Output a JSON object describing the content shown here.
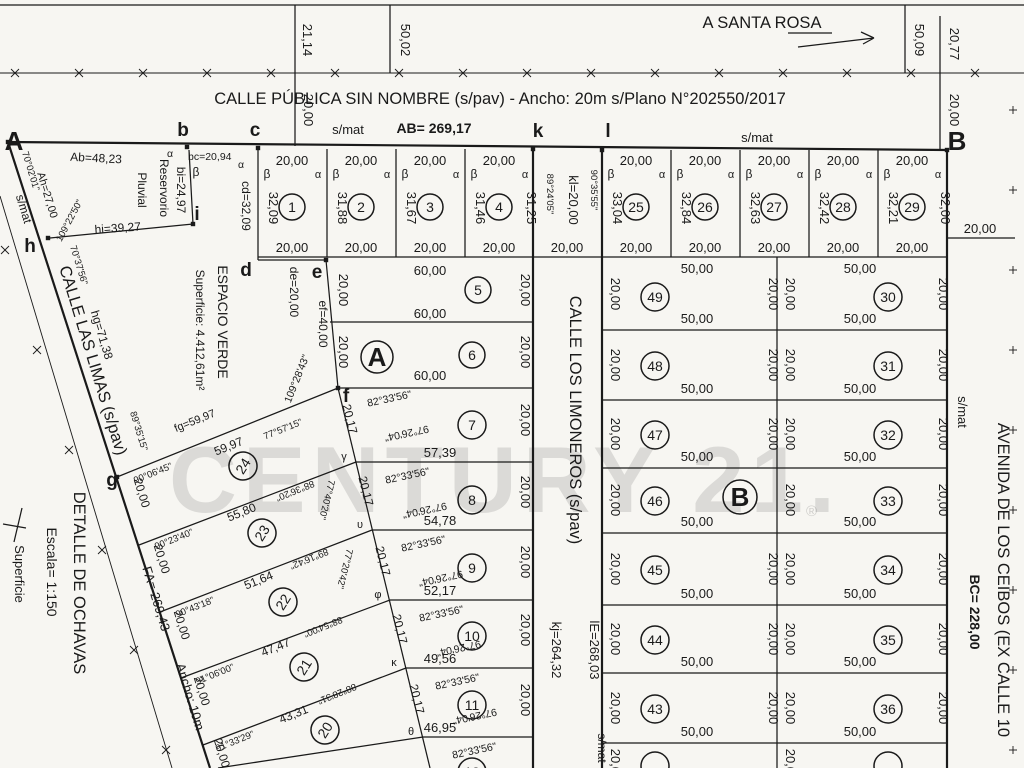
{
  "watermark": {
    "text": "CENTURY 21.",
    "reg": "®"
  },
  "common": {
    "d20": "20,00",
    "d50": "50,00",
    "alpha": "α",
    "beta": "β"
  },
  "top_strip": {
    "left_inner": "21,14",
    "left_outer": "50,02",
    "left_below": "20,00",
    "right_outer": "50,09",
    "right_inner": "20,77",
    "right_below": "20,00",
    "direction": "A SANTA ROSA",
    "street_title": "CALLE PÚBLICA SIN NOMBRE (s/pav) - Ancho: 20m s/Plano N°202550/2017"
  },
  "baseline": {
    "s_mat_left": "s/mat",
    "length": "AB= 269,17",
    "s_mat_right": "s/mat"
  },
  "points": {
    "A": "A",
    "b": "b",
    "c": "c",
    "d": "d",
    "e": "e",
    "f": "f",
    "g": "g",
    "h": "h",
    "i": "i",
    "k": "k",
    "l": "l",
    "B": "B"
  },
  "lots_1_4": [
    {
      "num": "1",
      "left_len": "32,09"
    },
    {
      "num": "2",
      "left_len": "31,88"
    },
    {
      "num": "3",
      "left_len": "31,67"
    },
    {
      "num": "4",
      "left_len": "31,46",
      "right_len": "31,25"
    }
  ],
  "limoneros_head": {
    "angle_left": "89°24'05\"",
    "length": "kl=20,00",
    "angle_right": "90°35'55\"",
    "width": "20,00"
  },
  "lots_25_29": [
    {
      "num": "25",
      "left_len": "33,04"
    },
    {
      "num": "26",
      "left_len": "32,84"
    },
    {
      "num": "27",
      "left_len": "32,63"
    },
    {
      "num": "28",
      "left_len": "32,42"
    },
    {
      "num": "29",
      "left_len": "32,21",
      "right_len": "32,00"
    }
  ],
  "outside_right_dim": "20,00",
  "right_block": {
    "section": "B",
    "col_left": [
      "49",
      "48",
      "47",
      "46",
      "45",
      "44",
      "43"
    ],
    "col_right": [
      "30",
      "31",
      "32",
      "33",
      "34",
      "35",
      "36"
    ]
  },
  "middle_block": {
    "section": "A",
    "lot5_num": "5",
    "lot5_len": "60,00",
    "lot6_num": "6",
    "lot6_len": "60,00",
    "angle_f": "109°28'43\"",
    "angle_top": "82°33'56\"",
    "angle_bottom": "97°26'04\"",
    "left_side": "20,17",
    "lots_7_12": [
      {
        "num": "7",
        "bottom": "57,39"
      },
      {
        "num": "8",
        "bottom": "54,78"
      },
      {
        "num": "9",
        "bottom": "52,17"
      },
      {
        "num": "10",
        "bottom": "49,56"
      },
      {
        "num": "11",
        "bottom": "46,95"
      },
      {
        "num": "12"
      }
    ],
    "vertex_letters": [
      "γ",
      "υ",
      "φ",
      "κ",
      "θ"
    ]
  },
  "limoneros_street": {
    "name": "CALLE LOS LIMONEROS (s/pav)",
    "kj": "kj=264,32",
    "le": "lE=268,03",
    "s_mat": "s/mat"
  },
  "espacio_verde": {
    "title": "ESPACIO VERDE",
    "superficie": "Superficie: 4.412,61m²",
    "bc": "bc=20,94",
    "cd": "cd=32,09",
    "de": "de=20,00",
    "ef": "ef=40,00"
  },
  "reservorio": {
    "name1": "Reservorio",
    "name2": "Pluvial",
    "ab": "Ab=48,23",
    "ah": "Ah=27,00",
    "bi": "bi=24,97",
    "hi": "hi=39,27",
    "angle_a": "70°02'01\"",
    "angle_h": "109°22'50\"",
    "angle_h_street": "70°37'56\""
  },
  "las_limas": {
    "name": "CALLE LAS LIMAS (s/pav)",
    "s_mat": "s/mat",
    "hg": "hg=71,38",
    "angle_g": "89°35'15\"",
    "fa": "FA= 269,43",
    "ancho": "Ancho: 10m"
  },
  "diagonal_lots": [
    {
      "num": "24",
      "fg": "fg=59,97",
      "top_len": "59,97",
      "angle_street": "90°06'45\"",
      "angle_f": "77°57'15\""
    },
    {
      "num": "23",
      "top_len": "55,80",
      "angle_street": "90°23'40\"",
      "angle_inv": "88°36'20\"",
      "angle_f": "77°40'20\""
    },
    {
      "num": "22",
      "top_len": "51,64",
      "angle_street": "90°43'18\"",
      "angle_inv": "89°16'42\"",
      "angle_f": "77°20'42\""
    },
    {
      "num": "21",
      "top_len": "47,47",
      "angle_street": "91°06'00\"",
      "angle_inv": "88°54'00\""
    },
    {
      "num": "20",
      "top_len": "43,31",
      "angle_street": "91°33'29\"",
      "angle_inv": "88°28'31\""
    }
  ],
  "avenida": {
    "name": "AVENIDA DE LOS CEIBOS (EX CALLE 10",
    "s_mat": "s/mat",
    "length": "BC= 228,00"
  },
  "detalle": {
    "title": "DETALLE DE OCHAVAS",
    "escala": "Escala= 1:150",
    "superficie": "Superficie"
  }
}
